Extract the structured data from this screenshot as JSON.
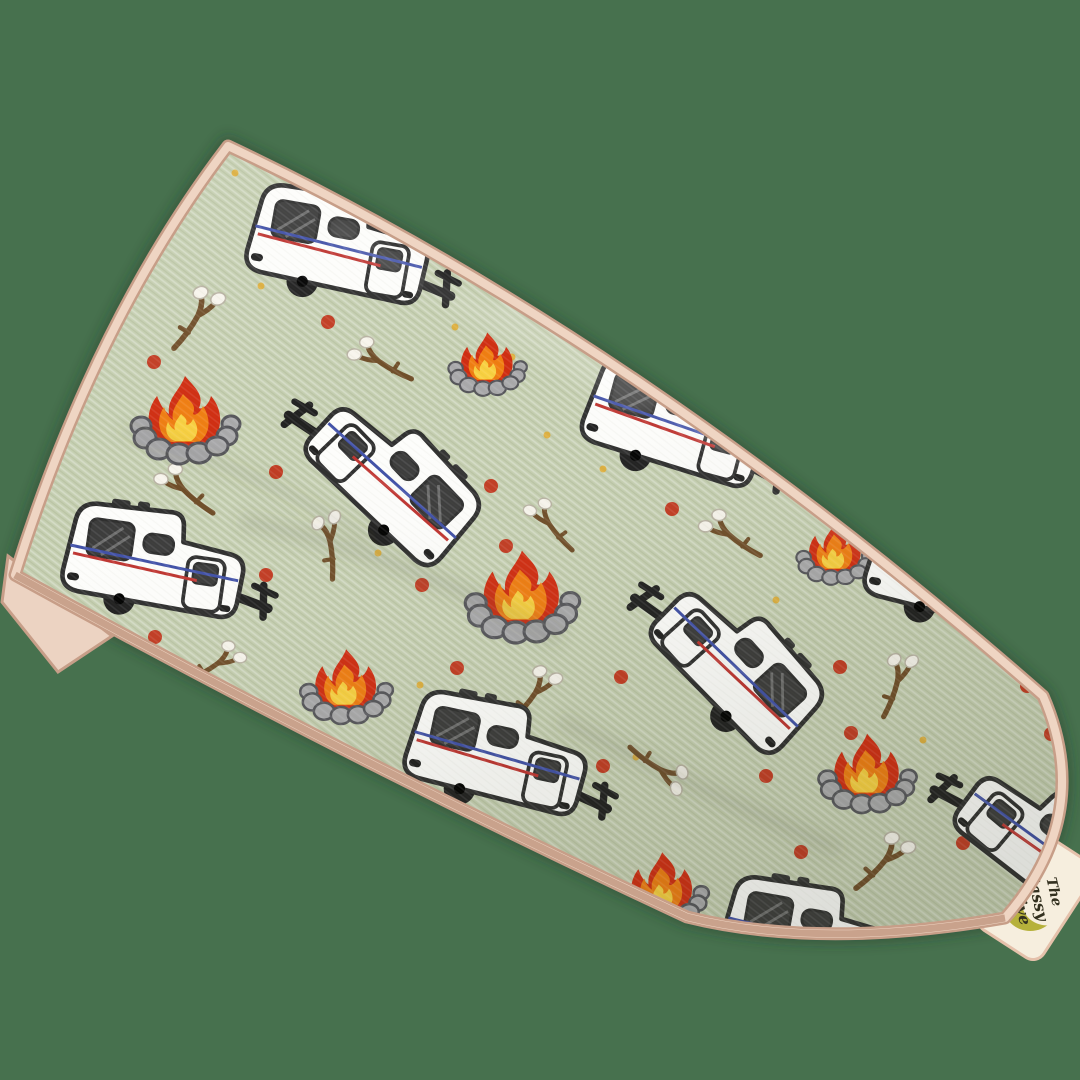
{
  "image": {
    "type": "product-photo",
    "subject": "Sage green stretch-knit headband printed with retro camper trailers, campfires and marshmallow roasting sticks, laid diagonally on a plain green backdrop",
    "background_color": "#47714e"
  },
  "fabric": {
    "base_color": "#c5cfb1",
    "trim_color": "#efd5c3",
    "trim_shadow_color": "#c49a82",
    "fold_backing_color": "#ecd3c2"
  },
  "tag": {
    "line1": "The",
    "line2": "Sassy",
    "line3": "Olive",
    "background": "#f6eede",
    "border": "#e5c1ab",
    "crescent_color": "#b6b13b",
    "accent_pink": "#f5cdd3",
    "text_color": "#33301f"
  },
  "pattern": {
    "motif_names": [
      "camper-trailer-icon",
      "campfire-icon",
      "marshmallow-stick-icon",
      "red-dot",
      "gold-speck"
    ],
    "camper_colors": {
      "body": "#fdfdfb",
      "outline": "#2e2e2e",
      "stripe_blue": "#4050a8",
      "stripe_red": "#bf3430",
      "window": "#3b3b3b",
      "wheel": "#1f1f1f"
    },
    "campfire_colors": {
      "flame_outer": "#d02c10",
      "flame_mid": "#f07d10",
      "flame_inner": "#f8d040",
      "stones": "#a9a9ab",
      "stone_outline": "#55555a"
    },
    "stick_colors": {
      "branch": "#6f4d28",
      "marshmallow": "#f7f4ec"
    },
    "dot_colors": {
      "red": "#c23b22",
      "gold": "#ddaf3f"
    },
    "campers": [
      {
        "x": 347,
        "y": 258,
        "rot": 10,
        "s": 0.93,
        "m": false
      },
      {
        "x": 378,
        "y": 480,
        "rot": 46,
        "s": 0.93,
        "m": true
      },
      {
        "x": 682,
        "y": 436,
        "rot": 15,
        "s": 0.93,
        "m": false
      },
      {
        "x": 163,
        "y": 574,
        "rot": 8,
        "s": 0.93,
        "m": false
      },
      {
        "x": 505,
        "y": 767,
        "rot": 12,
        "s": 0.93,
        "m": false
      },
      {
        "x": 722,
        "y": 666,
        "rot": 48,
        "s": 0.93,
        "m": true
      },
      {
        "x": 820,
        "y": 950,
        "rot": 10,
        "s": 0.93,
        "m": false
      },
      {
        "x": 1030,
        "y": 845,
        "rot": 40,
        "s": 0.93,
        "m": true
      },
      {
        "x": 965,
        "y": 585,
        "rot": 12,
        "s": 0.93,
        "m": false
      }
    ],
    "campfires": [
      {
        "x": 186,
        "y": 424,
        "s": 1.0
      },
      {
        "x": 488,
        "y": 367,
        "s": 0.72
      },
      {
        "x": 523,
        "y": 601,
        "s": 1.05
      },
      {
        "x": 347,
        "y": 690,
        "s": 0.85
      },
      {
        "x": 868,
        "y": 777,
        "s": 0.9
      },
      {
        "x": 836,
        "y": 556,
        "s": 0.72
      },
      {
        "x": 663,
        "y": 893,
        "s": 0.85
      }
    ],
    "sticks": [
      {
        "x": 194,
        "y": 312,
        "rot": -20,
        "s": 0.8,
        "m": false
      },
      {
        "x": 380,
        "y": 356,
        "rot": -5,
        "s": 0.75,
        "m": true
      },
      {
        "x": 186,
        "y": 485,
        "rot": 5,
        "s": 0.75,
        "m": true
      },
      {
        "x": 325,
        "y": 541,
        "rot": -60,
        "s": 0.75,
        "m": false
      },
      {
        "x": 552,
        "y": 520,
        "rot": 15,
        "s": 0.7,
        "m": true
      },
      {
        "x": 731,
        "y": 530,
        "rot": 0,
        "s": 0.75,
        "m": true
      },
      {
        "x": 532,
        "y": 689,
        "rot": -15,
        "s": 0.75,
        "m": false
      },
      {
        "x": 664,
        "y": 766,
        "rot": 70,
        "s": 0.75,
        "m": false
      },
      {
        "x": 882,
        "y": 856,
        "rot": -10,
        "s": 0.8,
        "m": false
      },
      {
        "x": 216,
        "y": 659,
        "rot": 5,
        "s": 0.7,
        "m": false
      },
      {
        "x": 893,
        "y": 679,
        "rot": -35,
        "s": 0.75,
        "m": false
      }
    ],
    "red_dots": [
      [
        328,
        322
      ],
      [
        154,
        362
      ],
      [
        276,
        472
      ],
      [
        491,
        486
      ],
      [
        506,
        546
      ],
      [
        422,
        585
      ],
      [
        266,
        575
      ],
      [
        155,
        637
      ],
      [
        457,
        668
      ],
      [
        621,
        677
      ],
      [
        603,
        766
      ],
      [
        672,
        509
      ],
      [
        851,
        733
      ],
      [
        1051,
        734
      ],
      [
        766,
        776
      ],
      [
        801,
        852
      ],
      [
        963,
        843
      ],
      [
        840,
        667
      ],
      [
        1027,
        686
      ]
    ],
    "gold_specks": [
      [
        235,
        173
      ],
      [
        261,
        286
      ],
      [
        455,
        327
      ],
      [
        512,
        357
      ],
      [
        378,
        553
      ],
      [
        420,
        685
      ],
      [
        636,
        757
      ],
      [
        923,
        740
      ],
      [
        603,
        469
      ],
      [
        776,
        600
      ],
      [
        547,
        435
      ]
    ]
  }
}
